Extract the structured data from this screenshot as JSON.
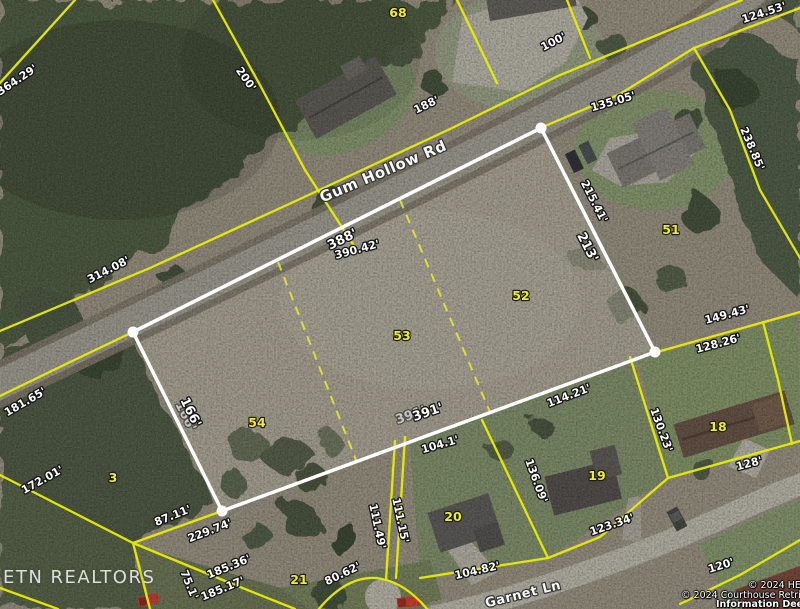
{
  "map": {
    "labels": [
      {
        "text": "364.29'",
        "x": 19,
        "y": 83,
        "rot": -34,
        "kind": "dim",
        "name": "dim-364-29"
      },
      {
        "text": "200'",
        "x": 243,
        "y": 81,
        "rot": 55,
        "kind": "dim",
        "name": "dim-200"
      },
      {
        "text": "68",
        "x": 398,
        "y": 17,
        "rot": 0,
        "kind": "num",
        "name": "parcel-68"
      },
      {
        "text": "188'",
        "x": 428,
        "y": 108,
        "rot": -26,
        "kind": "dim",
        "name": "dim-188"
      },
      {
        "text": "100'",
        "x": 555,
        "y": 45,
        "rot": -27,
        "kind": "dim",
        "name": "dim-100"
      },
      {
        "text": "124.53'",
        "x": 765,
        "y": 16,
        "rot": -18,
        "kind": "dim",
        "name": "dim-124-53"
      },
      {
        "text": "135.05'",
        "x": 614,
        "y": 105,
        "rot": -16,
        "kind": "dim",
        "name": "dim-135-05"
      },
      {
        "text": "238.85'",
        "x": 749,
        "y": 150,
        "rot": 67,
        "kind": "dim",
        "name": "dim-238-85"
      },
      {
        "text": "314.08'",
        "x": 110,
        "y": 273,
        "rot": -27,
        "kind": "dim",
        "name": "dim-314-08"
      },
      {
        "text": "Gum Hollow Rd",
        "x": 385,
        "y": 176,
        "rot": -23,
        "kind": "road",
        "size": 15,
        "name": "road-label-gum-hollow-rd"
      },
      {
        "text": "215.41'",
        "x": 591,
        "y": 203,
        "rot": 63,
        "kind": "dim",
        "name": "dim-215-41"
      },
      {
        "text": "213'",
        "x": 584,
        "y": 249,
        "rot": 63,
        "kind": "dim",
        "size": 13,
        "name": "dim-213"
      },
      {
        "text": "51",
        "x": 671,
        "y": 234,
        "rot": 0,
        "kind": "num",
        "name": "parcel-51"
      },
      {
        "text": "388'",
        "x": 344,
        "y": 243,
        "rot": -26,
        "kind": "dim",
        "size": 13,
        "name": "dim-388"
      },
      {
        "text": "390.42'",
        "x": 358,
        "y": 253,
        "rot": -15,
        "kind": "dim",
        "name": "dim-390-42"
      },
      {
        "text": "52",
        "x": 521,
        "y": 300,
        "rot": 0,
        "kind": "num",
        "name": "parcel-52"
      },
      {
        "text": "53",
        "x": 402,
        "y": 340,
        "rot": 0,
        "kind": "num",
        "name": "parcel-53"
      },
      {
        "text": "54",
        "x": 257,
        "y": 427,
        "rot": 0,
        "kind": "num",
        "name": "parcel-54"
      },
      {
        "text": "166'",
        "x": 187,
        "y": 414,
        "rot": 64,
        "kind": "dim",
        "size": 13,
        "ghost": [
          -5,
          4
        ],
        "name": "dim-166"
      },
      {
        "text": "391'",
        "x": 429,
        "y": 416,
        "rot": -19,
        "kind": "dim",
        "size": 13,
        "ghost": [
          -17,
          3
        ],
        "name": "dim-391"
      },
      {
        "text": "104.1'",
        "x": 441,
        "y": 448,
        "rot": -16,
        "kind": "dim",
        "name": "dim-104-1"
      },
      {
        "text": "181.65'",
        "x": 27,
        "y": 405,
        "rot": -30,
        "kind": "dim",
        "name": "dim-181-65"
      },
      {
        "text": "149.43'",
        "x": 728,
        "y": 318,
        "rot": -15,
        "kind": "dim",
        "name": "dim-149-43"
      },
      {
        "text": "128.26'",
        "x": 719,
        "y": 347,
        "rot": -15,
        "kind": "dim",
        "name": "dim-128-26"
      },
      {
        "text": "114.21'",
        "x": 570,
        "y": 399,
        "rot": -21,
        "kind": "dim",
        "name": "dim-114-21"
      },
      {
        "text": "130.23'",
        "x": 658,
        "y": 431,
        "rot": 70,
        "kind": "dim",
        "name": "dim-130-23"
      },
      {
        "text": "18",
        "x": 718,
        "y": 431,
        "rot": 0,
        "kind": "num",
        "name": "parcel-18"
      },
      {
        "text": "128'",
        "x": 750,
        "y": 467,
        "rot": -15,
        "kind": "dim",
        "name": "dim-128"
      },
      {
        "text": "136.09'",
        "x": 533,
        "y": 482,
        "rot": 70,
        "kind": "dim",
        "name": "dim-136-09"
      },
      {
        "text": "19",
        "x": 597,
        "y": 480,
        "rot": 0,
        "kind": "num",
        "name": "parcel-19"
      },
      {
        "text": "20",
        "x": 453,
        "y": 521,
        "rot": 0,
        "kind": "num",
        "name": "parcel-20"
      },
      {
        "text": "111.15'",
        "x": 397,
        "y": 521,
        "rot": 78,
        "kind": "dim",
        "name": "dim-111-15"
      },
      {
        "text": "111.49'",
        "x": 374,
        "y": 527,
        "rot": 78,
        "kind": "dim",
        "name": "dim-111-49"
      },
      {
        "text": "123.34'",
        "x": 613,
        "y": 528,
        "rot": -19,
        "kind": "dim",
        "name": "dim-123-34"
      },
      {
        "text": "104.82'",
        "x": 478,
        "y": 574,
        "rot": -13,
        "kind": "dim",
        "name": "dim-104-82"
      },
      {
        "text": "Garnet Ln",
        "x": 524,
        "y": 598,
        "rot": -14,
        "kind": "road",
        "size": 13,
        "name": "road-label-garnet-ln"
      },
      {
        "text": "120'",
        "x": 722,
        "y": 569,
        "rot": -17,
        "kind": "dim",
        "name": "dim-120"
      },
      {
        "text": "3",
        "x": 113,
        "y": 482,
        "rot": 0,
        "kind": "num",
        "name": "parcel-3"
      },
      {
        "text": "172.01'",
        "x": 44,
        "y": 483,
        "rot": -29,
        "kind": "dim",
        "name": "dim-172-01"
      },
      {
        "text": "87.11'",
        "x": 174,
        "y": 519,
        "rot": -22,
        "kind": "dim",
        "name": "dim-87-11"
      },
      {
        "text": "229.74'",
        "x": 211,
        "y": 534,
        "rot": -21,
        "kind": "dim",
        "name": "dim-229-74"
      },
      {
        "text": "185.36'",
        "x": 230,
        "y": 570,
        "rot": -22,
        "kind": "dim",
        "name": "dim-185-36"
      },
      {
        "text": "185.17'",
        "x": 224,
        "y": 592,
        "rot": -22,
        "kind": "dim",
        "name": "dim-185-17"
      },
      {
        "text": "75.1'",
        "x": 186,
        "y": 586,
        "rot": 68,
        "kind": "dim",
        "name": "dim-75-1"
      },
      {
        "text": "80.62'",
        "x": 344,
        "y": 577,
        "rot": -26,
        "kind": "dim",
        "name": "dim-80-62"
      },
      {
        "text": "21",
        "x": 299,
        "y": 584,
        "rot": 0,
        "kind": "num",
        "name": "parcel-21"
      }
    ],
    "colors": {
      "boundary_line": "#e9ee00",
      "highlight_boundary": "#ffffff",
      "dimension_label": "#ffffff",
      "parcel_number_label": "#f0ee2a"
    }
  },
  "overlay": {
    "watermark": "ETN REALTORS",
    "copyright_line1": "© 2024 HERE",
    "copyright_line2": "© 2024 Courthouse Retrieval Sy",
    "copyright_line3": "Information Deemed"
  }
}
